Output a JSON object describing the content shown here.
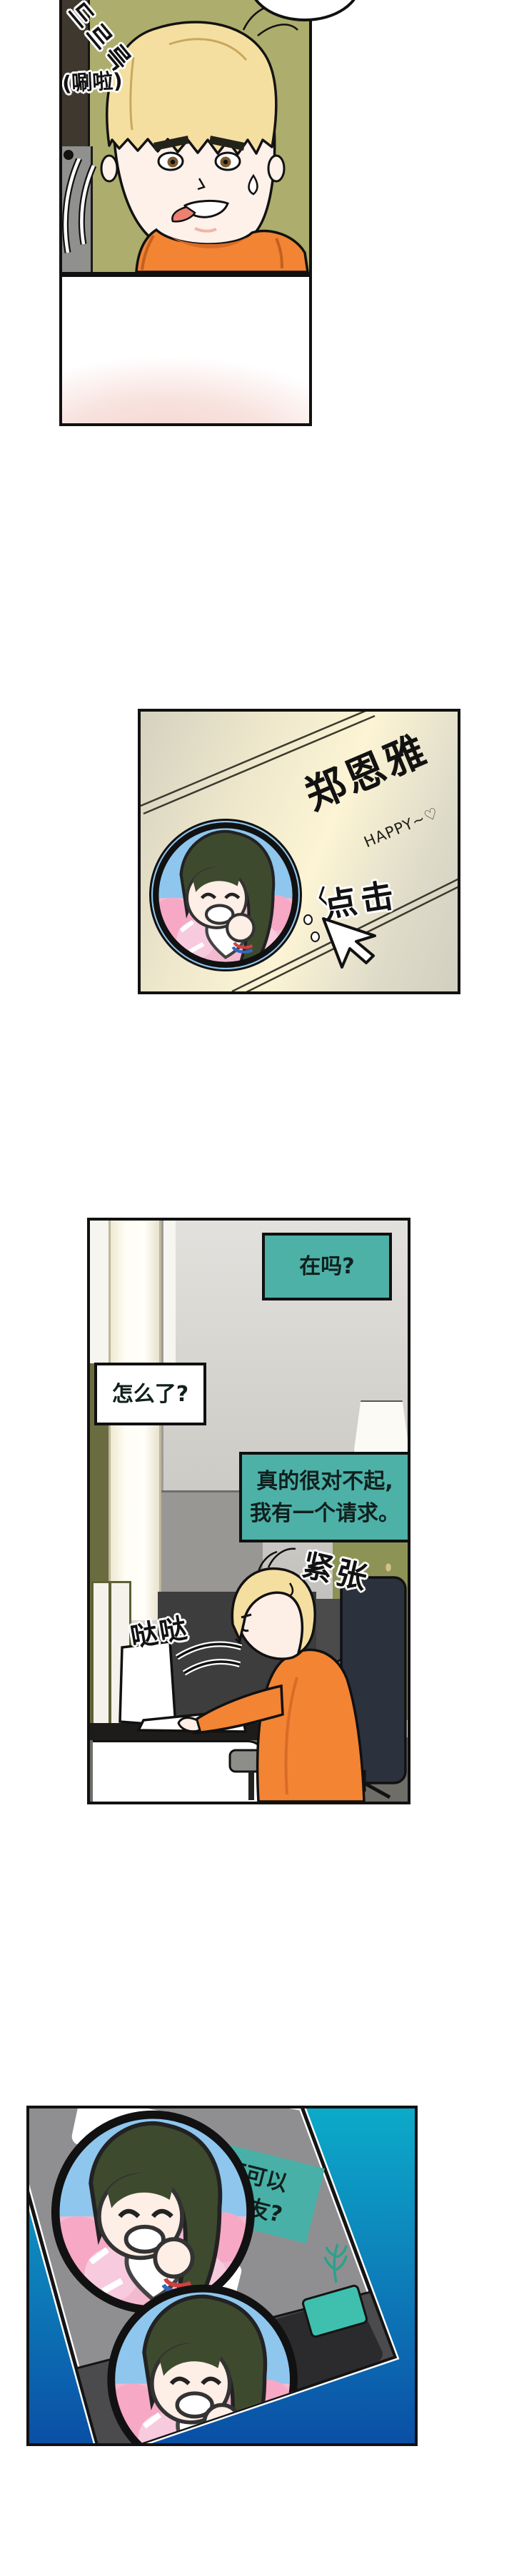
{
  "colors": {
    "teal_bubble": "#4DB1A8",
    "phone_button": "#3FC0AE",
    "panel5_bg_top": "#0CAAC9",
    "panel5_bg_bottom": "#0A4FA5",
    "wallpaper_green": "#ADAD6D",
    "shirt_orange": "#F28433"
  },
  "panel1": {
    "sfx_korean": "드르륵",
    "sfx_translation": "(唰啦)"
  },
  "panel3": {
    "profile_name": "郑恩雅",
    "status_text": "HAPPY~♡",
    "click_mark": "〈",
    "click_label": "点击"
  },
  "panel4": {
    "bubble_incoming_1": "在吗?",
    "bubble_reply": "怎么了?",
    "bubble_incoming_2_line1": "真的很对不起,",
    "bubble_incoming_2_line2": "我有一个请求。",
    "sfx_nervous": "紧张",
    "sfx_typing": "哒哒"
  },
  "panel5": {
    "msg_sent_line1": "周末你可不可以",
    "msg_sent_line2": "假装我女朋友?",
    "msg_reply_line1": "你疯了吗?",
    "msg_reply_line2": "喝醉了吗?"
  }
}
